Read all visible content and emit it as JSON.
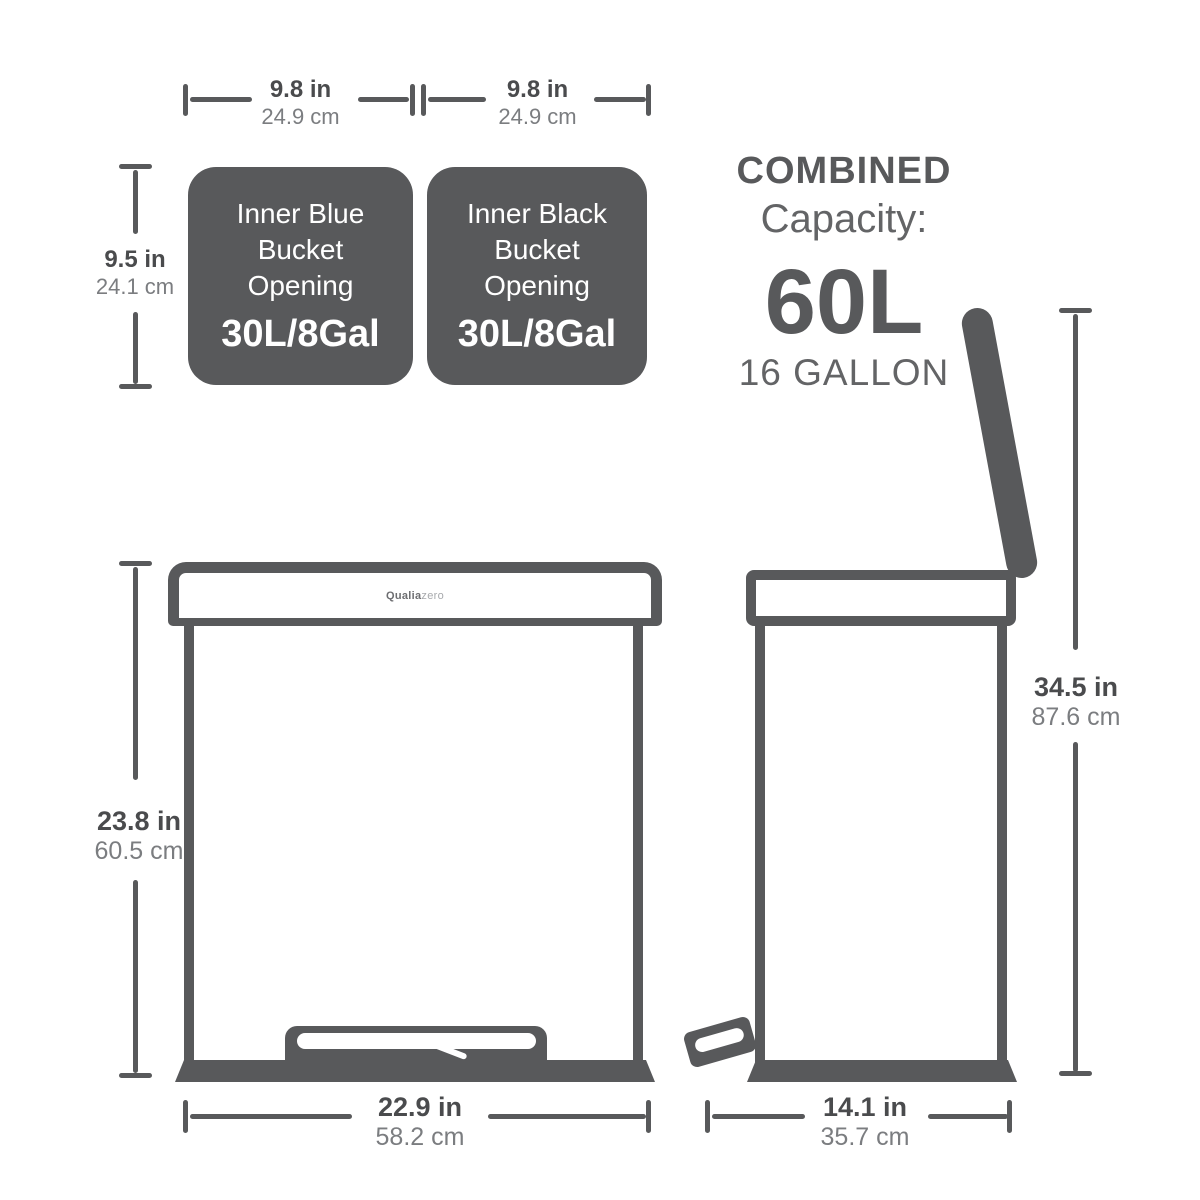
{
  "brand": {
    "bold": "Qualia",
    "light": "zero"
  },
  "colors": {
    "dark_gray": "#58595b",
    "subtext_gray": "#7b7d80",
    "white": "#ffffff"
  },
  "dims": {
    "opening_left_width": {
      "in": "9.8 in",
      "cm": "24.9 cm"
    },
    "opening_right_width": {
      "in": "9.8 in",
      "cm": "24.9 cm"
    },
    "opening_height": {
      "in": "9.5 in",
      "cm": "24.1 cm"
    },
    "front_height": {
      "in": "23.8 in",
      "cm": "60.5 cm"
    },
    "front_width": {
      "in": "22.9 in",
      "cm": "58.2 cm"
    },
    "side_height": {
      "in": "34.5 in",
      "cm": "87.6 cm"
    },
    "side_depth": {
      "in": "14.1 in",
      "cm": "35.7 cm"
    }
  },
  "buckets": [
    {
      "line1": "Inner Blue",
      "line2": "Bucket",
      "line3": "Opening",
      "capacity": "30L/8Gal"
    },
    {
      "line1": "Inner Black",
      "line2": "Bucket",
      "line3": "Opening",
      "capacity": "30L/8Gal"
    }
  ],
  "combined": {
    "title": "COMBINED",
    "subtitle": "Capacity:",
    "value": "60L",
    "gallons": "16 GALLON"
  }
}
